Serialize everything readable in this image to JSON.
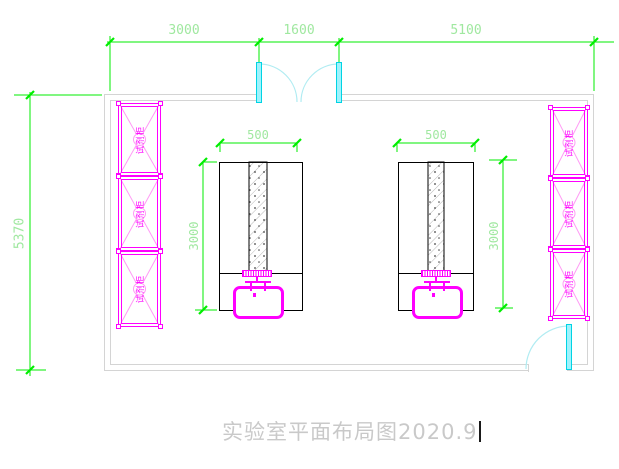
{
  "drawing": {
    "title": "实验室平面布局图2020.9",
    "dimensions": {
      "top_left": "3000",
      "top_middle": "1600",
      "top_right": "5100",
      "left_height": "5370",
      "left_bench_width": "500",
      "left_bench_depth": "3000",
      "right_bench_width": "500",
      "right_bench_depth": "3000"
    },
    "cabinets": {
      "left": [
        {
          "label": "试剂柜"
        },
        {
          "label": "试剂柜"
        },
        {
          "label": "试剂柜"
        }
      ],
      "right": [
        {
          "label": "试剂柜"
        },
        {
          "label": "试剂柜"
        },
        {
          "label": "试剂柜"
        }
      ]
    },
    "colors": {
      "dimension_line": "#00ee00",
      "dimension_text": "#a0e8a0",
      "cabinet": "#ff00ff",
      "door": "#00d4e4",
      "door_arc": "#b0ecf2",
      "wall": "#d4d4d4",
      "bench_outline": "#000000",
      "title_text": "#c9c9c9"
    }
  }
}
